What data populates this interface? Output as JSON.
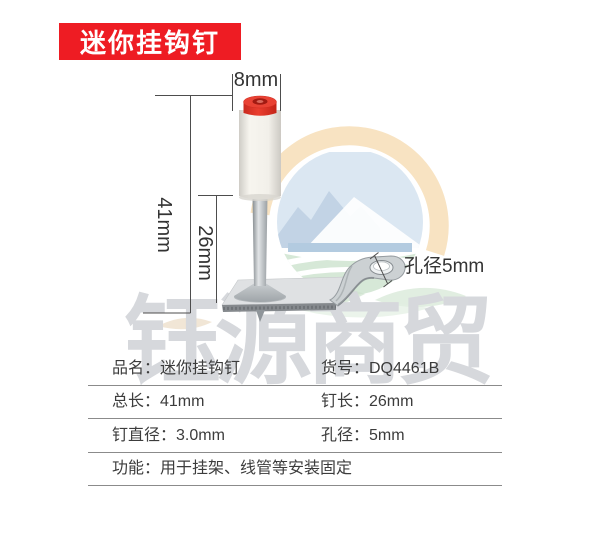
{
  "badge": {
    "label": "迷你挂钩钉"
  },
  "watermark": {
    "text": "钰源商贸"
  },
  "diagram": {
    "dim_cap_width": "8mm",
    "dim_total_length": "41mm",
    "dim_pin_length": "26mm",
    "hole_label": "孔径5mm"
  },
  "table": {
    "rows": [
      {
        "cells": [
          "品名：迷你挂钩钉",
          "货号：DQ4461B"
        ]
      },
      {
        "cells": [
          "总长：41mm",
          "钉长：26mm"
        ]
      },
      {
        "cells": [
          "钉直径：3.0mm",
          "孔径：5mm"
        ]
      },
      {
        "cells": [
          "功能：用于挂架、线管等安装固定"
        ]
      }
    ]
  },
  "colors": {
    "badge_bg": "#ee1c23",
    "cap_red": "#e8392c",
    "dimension_line": "#4d4d4d",
    "table_line": "#8b8b8b",
    "table_text": "#3c3c3c",
    "watermark_text": "#d6d8dc",
    "logo_peach": "#f8e3c2",
    "logo_blue": "#c2d3e5",
    "logo_green": "#d6e8d7"
  }
}
